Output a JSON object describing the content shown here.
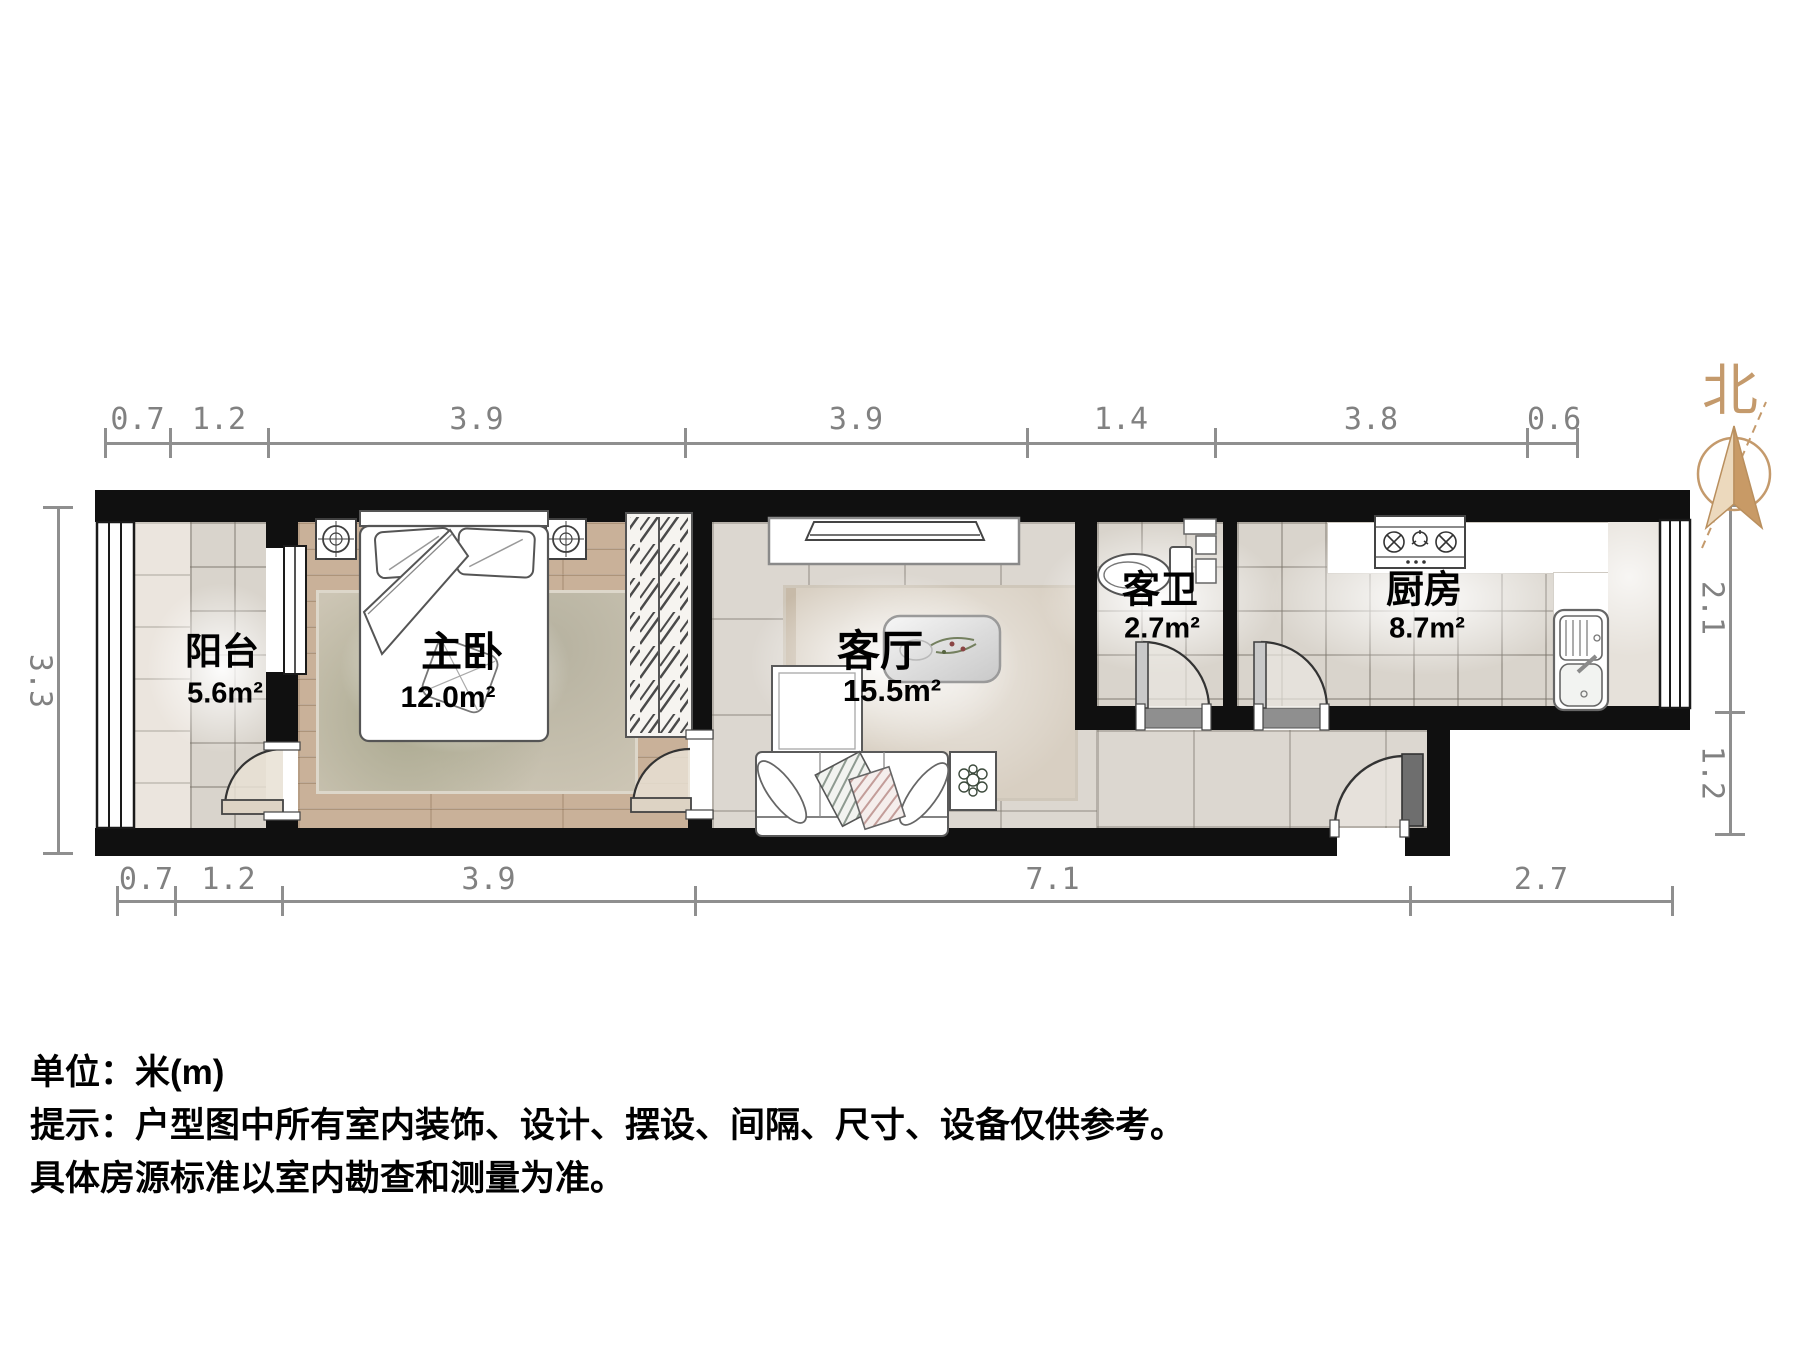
{
  "north": {
    "label": "北"
  },
  "rooms": {
    "balcony": {
      "name": "阳台",
      "area": "5.6m²"
    },
    "bedroom": {
      "name": "主卧",
      "area": "12.0m²"
    },
    "living": {
      "name": "客厅",
      "area": "15.5m²"
    },
    "bathroom": {
      "name": "客卫",
      "area": "2.7m²"
    },
    "kitchen": {
      "name": "厨房",
      "area": "8.7m²"
    }
  },
  "dimensions": {
    "top": [
      "0.7",
      "1.2",
      "3.9",
      "3.9",
      "1.4",
      "3.8",
      "0.6"
    ],
    "bottom": [
      "0.7",
      "1.2",
      "3.9",
      "7.1",
      "2.7"
    ],
    "left": [
      "3.3"
    ],
    "right": [
      "2.1",
      "1.2"
    ]
  },
  "footer": {
    "line1": "单位：米(m)",
    "line2": "提示：户型图中所有室内装饰、设计、摆设、间隔、尺寸、设备仅供参考。",
    "line3": "具体房源标准以室内勘查和测量为准。"
  },
  "colors": {
    "north_accent": "#c49a6c",
    "wall": "#101010",
    "dimension": "#8f8f8f"
  }
}
